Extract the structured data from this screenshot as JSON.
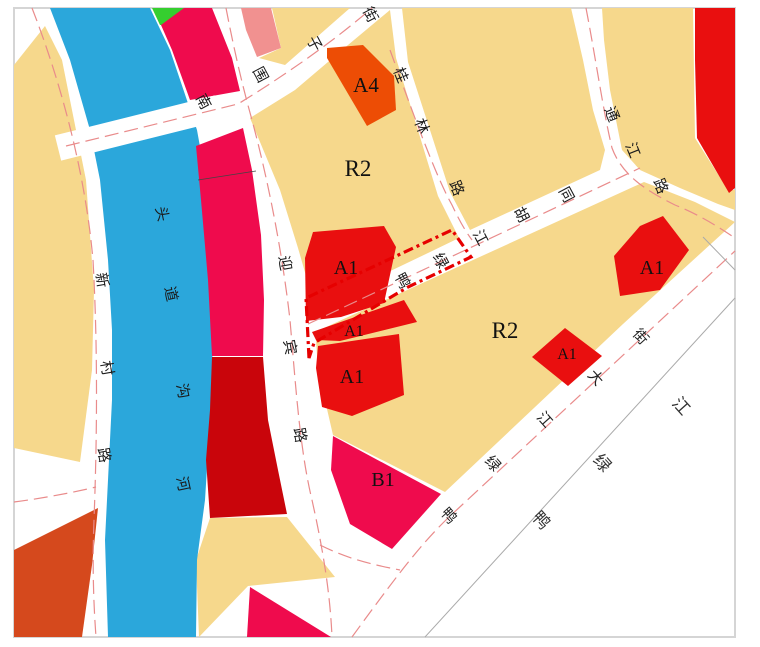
{
  "map": {
    "kind": "urban land-use zoning map"
  },
  "zones": [
    {
      "id": "a4",
      "code": "A4"
    },
    {
      "id": "r2-north",
      "code": "R2"
    },
    {
      "id": "a1-main",
      "code": "A1"
    },
    {
      "id": "a1-mid",
      "code": "A1"
    },
    {
      "id": "a1-south",
      "code": "A1"
    },
    {
      "id": "r2-south",
      "code": "R2"
    },
    {
      "id": "a1-diamond",
      "code": "A1"
    },
    {
      "id": "a1-east",
      "code": "A1"
    },
    {
      "id": "b1",
      "code": "B1"
    }
  ],
  "roads": {
    "xincun": {
      "name": "新村路",
      "chars": [
        "新",
        "村",
        "路"
      ]
    },
    "yingbin": {
      "name": "迎宾路",
      "chars": [
        "迎",
        "宾",
        "路"
      ]
    },
    "nanweizi": {
      "name": "南围子街",
      "chars": [
        "南",
        "围",
        "子",
        "街"
      ]
    },
    "guilin": {
      "name": "桂林路",
      "chars": [
        "桂",
        "林",
        "路"
      ]
    },
    "tongjiang": {
      "name": "通江路",
      "chars": [
        "通",
        "江",
        "路"
      ]
    },
    "hutong": {
      "name": "鸭绿江胡同",
      "chars": [
        "鸭",
        "绿",
        "江",
        "胡",
        "同"
      ]
    },
    "dajie": {
      "name": "鸭绿江大街",
      "chars": [
        "鸭",
        "绿",
        "江",
        "大",
        "街"
      ]
    }
  },
  "waters": {
    "toudaogou": {
      "name": "头道沟河",
      "chars": [
        "头",
        "道",
        "沟",
        "河"
      ]
    },
    "yalu": {
      "name": "鸭绿江",
      "chars": [
        "鸭",
        "绿",
        "江"
      ]
    }
  },
  "colors": {
    "residential_yellow": "#F6D88C",
    "red_a1": "#E90F0F",
    "crimson_b1": "#EF0B4D",
    "dark_red": "#C9050B",
    "vermilion": "#D5491D",
    "orange_a4": "#ED4D05",
    "salmon_pink": "#F19190",
    "green": "#35CE2F",
    "water_blue": "#2BA7DB",
    "road_white": "#FFFFFF",
    "centerline_pink": "#E98B8B",
    "site_boundary_red": "#E60000",
    "frame_gray": "#D5D5D5"
  }
}
